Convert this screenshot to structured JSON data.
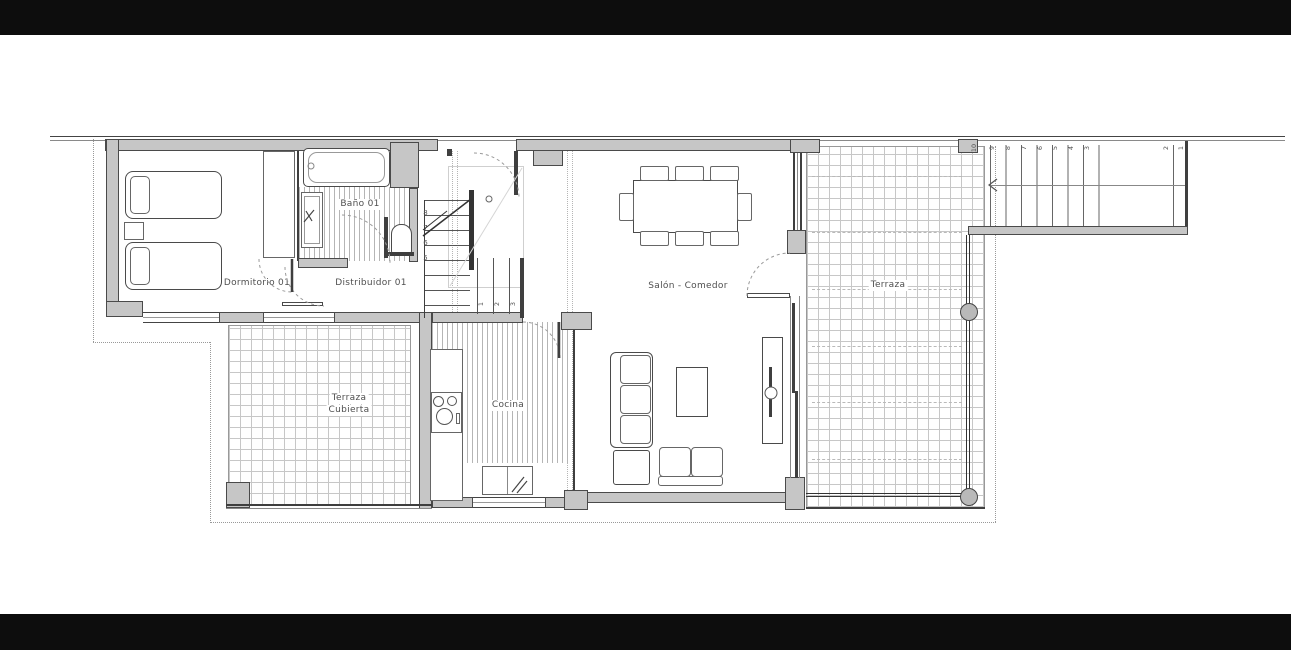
{
  "plan": {
    "rooms": {
      "dormitorio": {
        "label": "Dormitorio 01"
      },
      "bano": {
        "label": "Baño 01"
      },
      "distribuidor": {
        "label": "Distribuidor 01"
      },
      "salon": {
        "label": "Salón - Comedor"
      },
      "cocina": {
        "label": "Cocina"
      },
      "terraza": {
        "label": "Terraza"
      },
      "terraza_cubierta": {
        "line1": "Terraza",
        "line2": "Cubierta"
      }
    },
    "stairs": {
      "exterior": {
        "numbers": [
          "10",
          "9",
          "8",
          "7",
          "6",
          "5",
          "4",
          "3",
          "2",
          "1"
        ]
      },
      "interior": {
        "left_run": [
          "8",
          "7",
          "6",
          "5"
        ],
        "lower_run": [
          "1",
          "2",
          "3"
        ]
      }
    },
    "colors": {
      "wall_fill": "#c6c6c6",
      "line": "#3f3f3f",
      "tile_line": "#c7c7c7",
      "label": "#4f4f4f",
      "matte": "#0d0d0d",
      "background": "#ffffff"
    }
  }
}
